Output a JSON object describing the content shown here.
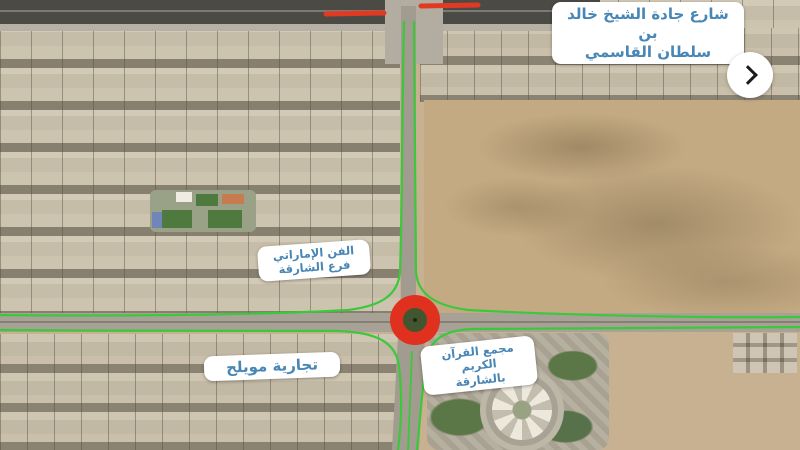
{
  "labels": {
    "street": {
      "line1": "شارع جادة الشيخ خالد بن",
      "line2": "سلطان القاسمي"
    },
    "art": {
      "line1": "الفن الإماراتي",
      "line2": "فرع الشارقة"
    },
    "muwaileh": {
      "line1": "تجارية مويلح"
    },
    "quran": {
      "line1": "مجمع القرآن الكريم",
      "line2": "بالشارقة"
    }
  },
  "controls": {
    "next_icon": "chevron-right"
  },
  "colors": {
    "route_green": "#3bc83b",
    "congestion_red": "#e23a22",
    "roundabout_red": "#e0301e",
    "roundabout_green": "#41562f",
    "label_text_blue": "#4886b5",
    "label_bg": "#ffffff",
    "highway_dark": "#4c4a45",
    "road_gray": "#a29b8f",
    "sand": "#c8b190",
    "desert": "#c3aa83",
    "urban_base": "#b6ac93"
  }
}
